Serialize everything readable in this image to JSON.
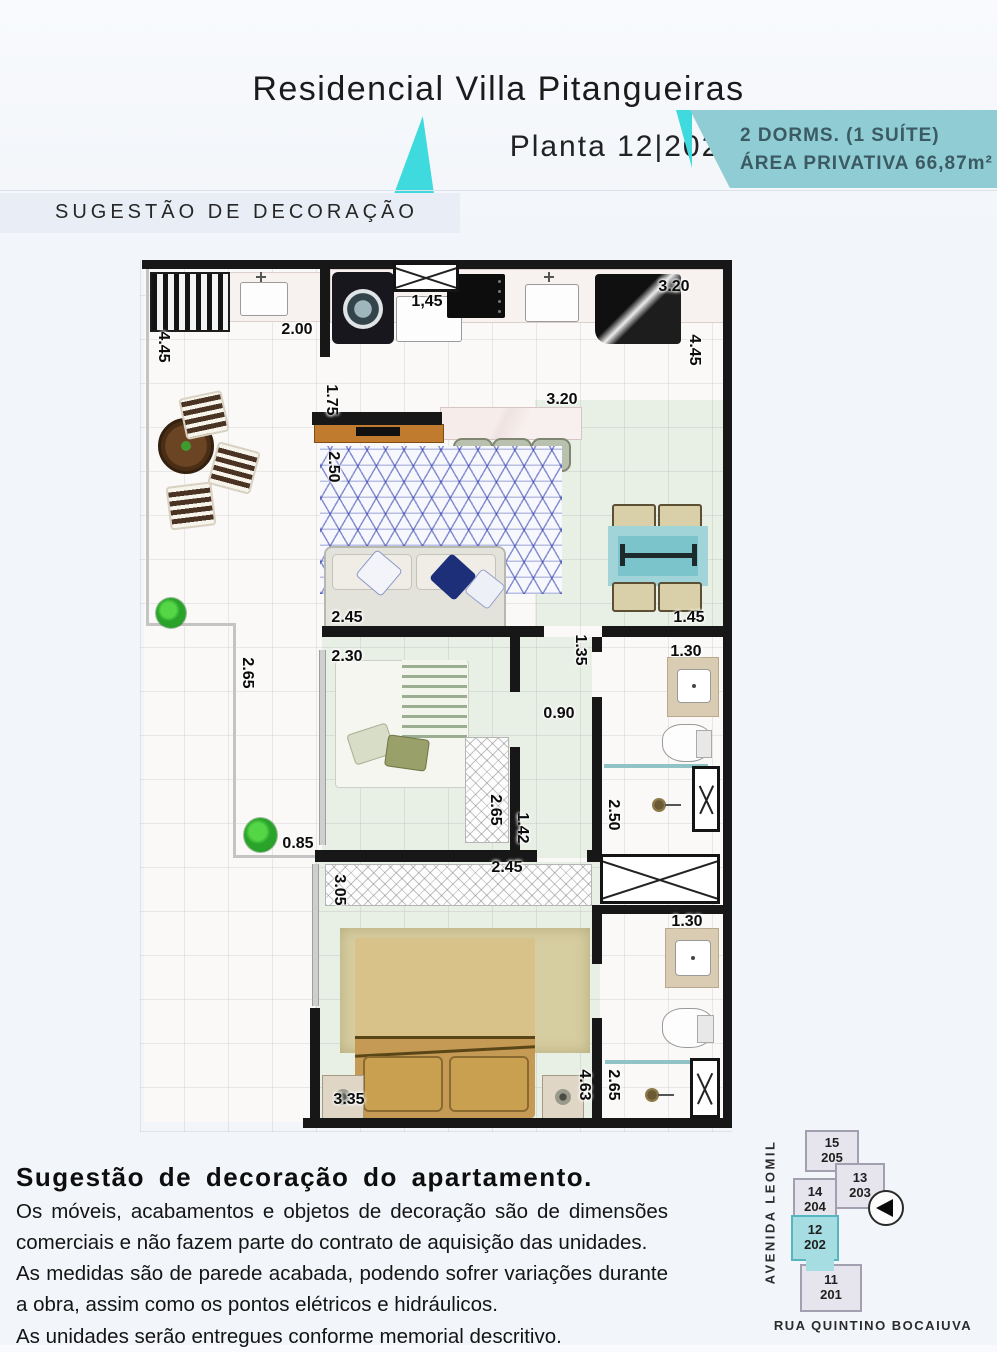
{
  "header": {
    "title": "Residencial Villa Pitangueiras",
    "plan_label": "Planta 12|202",
    "badge_line1": "2 DORMS. (1 SUÍTE)",
    "badge_line2": "ÁREA PRIVATIVA 66,87m²",
    "section_label": "SUGESTÃO DE DECORAÇÃO"
  },
  "colors": {
    "accent_cyan": "#3edade",
    "badge_bg": "#8fccd3",
    "badge_text": "#3b5a64",
    "wall": "#171717",
    "floor_green": "#e8efe5",
    "rug_line_blue": "#2c3aaa",
    "minimap_highlight": "#a5dde2"
  },
  "icons": {
    "logo": "teal-sail-triangle-icon",
    "compass": "compass-arrow-left-icon"
  },
  "plan": {
    "dimensions": [
      {
        "t": "4.45",
        "x": 23,
        "y": 87,
        "r": 90
      },
      {
        "t": "2.00",
        "x": 157,
        "y": 70,
        "r": 0
      },
      {
        "t": "1,45",
        "x": 287,
        "y": 42,
        "r": 0
      },
      {
        "t": "3.20",
        "x": 534,
        "y": 27,
        "r": 0
      },
      {
        "t": "4.45",
        "x": 554,
        "y": 90,
        "r": 90
      },
      {
        "t": "1.75",
        "x": 191,
        "y": 140,
        "r": 90
      },
      {
        "t": "3.20",
        "x": 422,
        "y": 140,
        "r": 0
      },
      {
        "t": "2.50",
        "x": 193,
        "y": 207,
        "r": 90
      },
      {
        "t": "2.45",
        "x": 207,
        "y": 358,
        "r": 0
      },
      {
        "t": "1.45",
        "x": 549,
        "y": 358,
        "r": 0
      },
      {
        "t": "2.65",
        "x": 107,
        "y": 413,
        "r": 90
      },
      {
        "t": "2.30",
        "x": 207,
        "y": 397,
        "r": 0
      },
      {
        "t": "1.35",
        "x": 440,
        "y": 390,
        "r": 90
      },
      {
        "t": "1.30",
        "x": 546,
        "y": 392,
        "r": 0
      },
      {
        "t": "0.90",
        "x": 419,
        "y": 454,
        "r": 0
      },
      {
        "t": "2.50",
        "x": 473,
        "y": 555,
        "r": 90
      },
      {
        "t": "2.65",
        "x": 355,
        "y": 550,
        "r": 90
      },
      {
        "t": "1.42",
        "x": 382,
        "y": 568,
        "r": 90
      },
      {
        "t": "0.85",
        "x": 158,
        "y": 584,
        "r": 0
      },
      {
        "t": "2.45",
        "x": 367,
        "y": 608,
        "r": 0
      },
      {
        "t": "3.05",
        "x": 199,
        "y": 630,
        "r": 90
      },
      {
        "t": "1.30",
        "x": 547,
        "y": 662,
        "r": 0
      },
      {
        "t": "3.35",
        "x": 209,
        "y": 840,
        "r": 0
      },
      {
        "t": "4.63",
        "x": 444,
        "y": 825,
        "r": 90
      },
      {
        "t": "2.65",
        "x": 473,
        "y": 825,
        "r": 90
      }
    ]
  },
  "disclaimer": {
    "title": "Sugestão de decoração do apartamento.",
    "lines": [
      "Os móveis, acabamentos e objetos de decoração são de dimensões comerciais e não fazem parte do contrato de aquisição das unidades.",
      "As medidas são de parede acabada, podendo sofrer variações durante a obra, assim como os pontos elétricos e hidráulicos.",
      "As unidades serão entregues conforme memorial descritivo."
    ]
  },
  "minimap": {
    "street_left": "AVENIDA LEOMIL",
    "street_bottom": "RUA QUINTINO BOCAIUVA",
    "units": [
      {
        "floor": "15",
        "apt": "205",
        "x": 57,
        "y": 12,
        "w": 54,
        "h": 42,
        "highlight": false
      },
      {
        "floor": "13",
        "apt": "203",
        "x": 87,
        "y": 45,
        "w": 50,
        "h": 46,
        "highlight": false
      },
      {
        "floor": "14",
        "apt": "204",
        "x": 45,
        "y": 60,
        "w": 44,
        "h": 44,
        "highlight": false
      },
      {
        "floor": "12",
        "apt": "202",
        "x": 43,
        "y": 97,
        "w": 48,
        "h": 46,
        "highlight": true
      },
      {
        "floor": "11",
        "apt": "201",
        "x": 52,
        "y": 146,
        "w": 62,
        "h": 48,
        "highlight": false
      }
    ]
  }
}
